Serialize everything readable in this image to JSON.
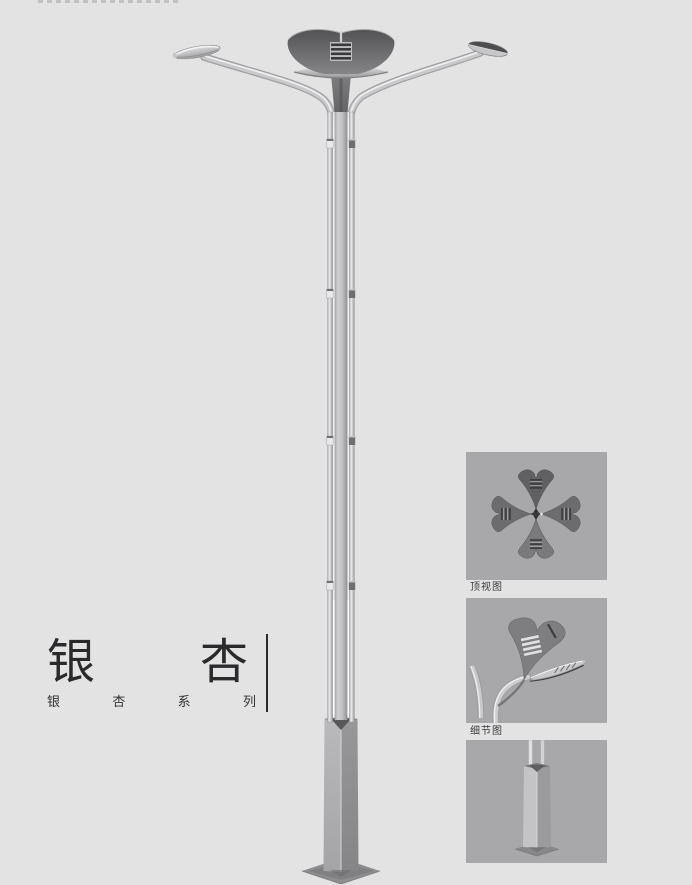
{
  "title": {
    "left_char": "银",
    "right_char": "杏"
  },
  "series_label": {
    "chars": [
      "银",
      "杏",
      "系",
      "列"
    ]
  },
  "detail_panel": {
    "boxes": [
      {
        "id": "top-view",
        "caption": "顶视图"
      },
      {
        "id": "detail-view",
        "caption": "细节图"
      },
      {
        "id": "base-view",
        "caption": ""
      }
    ]
  },
  "colors": {
    "page_bg": "#e3e3e4",
    "panel_bg": "#a8a8aa",
    "title_text": "#2a2a2c",
    "caption_text": "#3a3a3c",
    "divider": "#2b2b2d",
    "metal_light": "#d9d9db",
    "metal_mid": "#bcbcbe",
    "metal_dark": "#6f6f71"
  }
}
